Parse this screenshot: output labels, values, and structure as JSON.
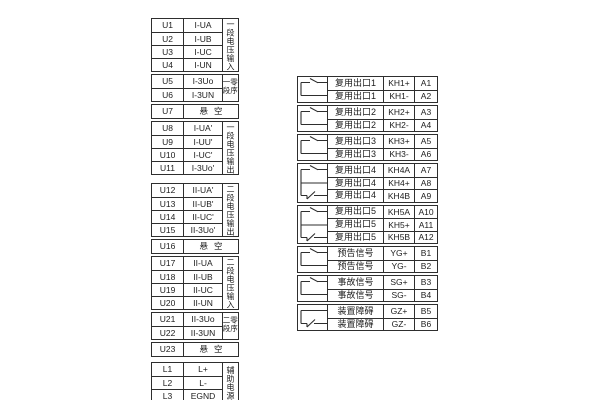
{
  "meta": {
    "diagram_type": "terminal-wiring-diagram",
    "background_color": "#ffffff",
    "line_color": "#2e2e2e",
    "text_color": "#1c1c1c"
  },
  "symbols": {
    "no2": "normally-open-contact",
    "co3": "changeover-contact",
    "nc2": "normally-closed-contact"
  },
  "left": {
    "groups": [
      {
        "side": "一段电压输入",
        "rows": [
          {
            "t": "U1",
            "v": "I-UA"
          },
          {
            "t": "U2",
            "v": "I-UB"
          },
          {
            "t": "U3",
            "v": "I-UC"
          },
          {
            "t": "U4",
            "v": "I-UN"
          }
        ]
      },
      {
        "side": "一段零序",
        "rows": [
          {
            "t": "U5",
            "v": "I-3Uo"
          },
          {
            "t": "U6",
            "v": "I-3UN"
          }
        ]
      },
      {
        "rows": [
          {
            "t": "U7",
            "v": "悬空"
          }
        ]
      },
      {
        "side": "一段电压输出",
        "rows": [
          {
            "t": "U8",
            "v": "I-UA'"
          },
          {
            "t": "U9",
            "v": "I-UU'"
          },
          {
            "t": "U10",
            "v": "I-UC'"
          },
          {
            "t": "U11",
            "v": "I-3Uo'"
          }
        ]
      },
      {
        "side": "二段电压输出",
        "rows": [
          {
            "t": "U12",
            "v": "II-UA'"
          },
          {
            "t": "U13",
            "v": "II-UB'"
          },
          {
            "t": "U14",
            "v": "II-UC'"
          },
          {
            "t": "U15",
            "v": "II-3Uo'"
          }
        ]
      },
      {
        "rows": [
          {
            "t": "U16",
            "v": "悬空"
          }
        ]
      },
      {
        "side": "二段电压输入",
        "rows": [
          {
            "t": "U17",
            "v": "II-UA"
          },
          {
            "t": "U18",
            "v": "II-UB"
          },
          {
            "t": "U19",
            "v": "II-UC"
          },
          {
            "t": "U20",
            "v": "II-UN"
          }
        ]
      },
      {
        "side": "二段零序",
        "rows": [
          {
            "t": "U21",
            "v": "II-3Uo"
          },
          {
            "t": "U22",
            "v": "II-3UN"
          }
        ]
      },
      {
        "rows": [
          {
            "t": "U23",
            "v": "悬空"
          }
        ]
      },
      {
        "side": "辅助电源",
        "rows": [
          {
            "t": "L1",
            "v": "L+"
          },
          {
            "t": "L2",
            "v": "L-"
          },
          {
            "t": "L3",
            "v": "EGND"
          }
        ]
      }
    ]
  },
  "right": {
    "groups": [
      {
        "symbol": "no2",
        "rows": [
          {
            "label": "复用出口1",
            "kh": "KH1+",
            "a": "A1"
          },
          {
            "label": "复用出口1",
            "kh": "KH1-",
            "a": "A2"
          }
        ]
      },
      {
        "symbol": "no2",
        "rows": [
          {
            "label": "复用出口2",
            "kh": "KH2+",
            "a": "A3"
          },
          {
            "label": "复用出口2",
            "kh": "KH2-",
            "a": "A4"
          }
        ]
      },
      {
        "symbol": "no2",
        "rows": [
          {
            "label": "复用出口3",
            "kh": "KH3+",
            "a": "A5"
          },
          {
            "label": "复用出口3",
            "kh": "KH3-",
            "a": "A6"
          }
        ]
      },
      {
        "symbol": "co3",
        "rows": [
          {
            "label": "复用出口4",
            "kh": "KH4A",
            "a": "A7"
          },
          {
            "label": "复用出口4",
            "kh": "KH4+",
            "a": "A8"
          },
          {
            "label": "复用出口4",
            "kh": "KH4B",
            "a": "A9"
          }
        ]
      },
      {
        "symbol": "co3",
        "rows": [
          {
            "label": "复用出口5",
            "kh": "KH5A",
            "a": "A10"
          },
          {
            "label": "复用出口5",
            "kh": "KH5+",
            "a": "A11"
          },
          {
            "label": "复用出口5",
            "kh": "KH5B",
            "a": "A12"
          }
        ]
      },
      {
        "symbol": "no2",
        "rows": [
          {
            "label": "预告信号",
            "kh": "YG+",
            "a": "B1"
          },
          {
            "label": "预告信号",
            "kh": "YG-",
            "a": "B2"
          }
        ]
      },
      {
        "symbol": "no2",
        "rows": [
          {
            "label": "事故信号",
            "kh": "SG+",
            "a": "B3"
          },
          {
            "label": "事故信号",
            "kh": "SG-",
            "a": "B4"
          }
        ]
      },
      {
        "symbol": "nc2",
        "rows": [
          {
            "label": "装置障碍",
            "kh": "GZ+",
            "a": "B5"
          },
          {
            "label": "装置障碍",
            "kh": "GZ-",
            "a": "B6"
          }
        ]
      }
    ]
  }
}
